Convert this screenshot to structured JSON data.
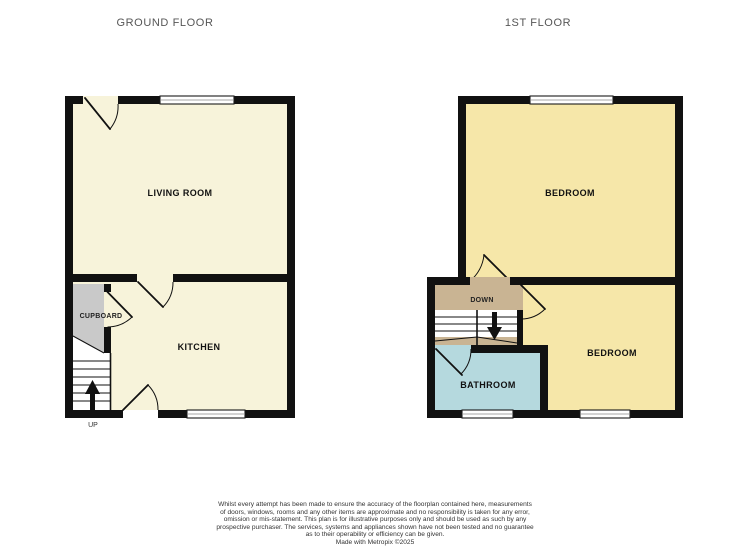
{
  "titles": {
    "ground_floor": "GROUND FLOOR",
    "first_floor": "1ST FLOOR"
  },
  "ground_floor": {
    "living_room_label": "LIVING ROOM",
    "kitchen_label": "KITCHEN",
    "cupboard_label": "CUPBOARD",
    "stairs_direction_label": "UP"
  },
  "first_floor": {
    "bedroom_front_label": "BEDROOM",
    "bedroom_back_label": "BEDROOM",
    "bathroom_label": "BATHROOM",
    "stairs_direction_label": "DOWN"
  },
  "disclaimer": {
    "lines": [
      "Whilst every attempt has been made to ensure the accuracy of the floorplan contained here, measurements",
      "of doors, windows, rooms and any other items are approximate and no responsibility is taken for any error,",
      "omission or mis-statement. This plan is for illustrative purposes only and should be used as such by any",
      "prospective purchaser. The services, systems and appliances shown have not been tested and no guarantee",
      "as to their operability or efficiency can be given.",
      "Made with Metropix ©2025"
    ]
  },
  "colors": {
    "wall": "#111111",
    "ground_room_cream": "#f7f3da",
    "cupboard_gray": "#c9c9c9",
    "bedroom_yellow": "#f6e7a9",
    "landing_tan": "#c9b493",
    "bathroom_blue": "#b5d9de",
    "window_white": "#ffffff"
  }
}
